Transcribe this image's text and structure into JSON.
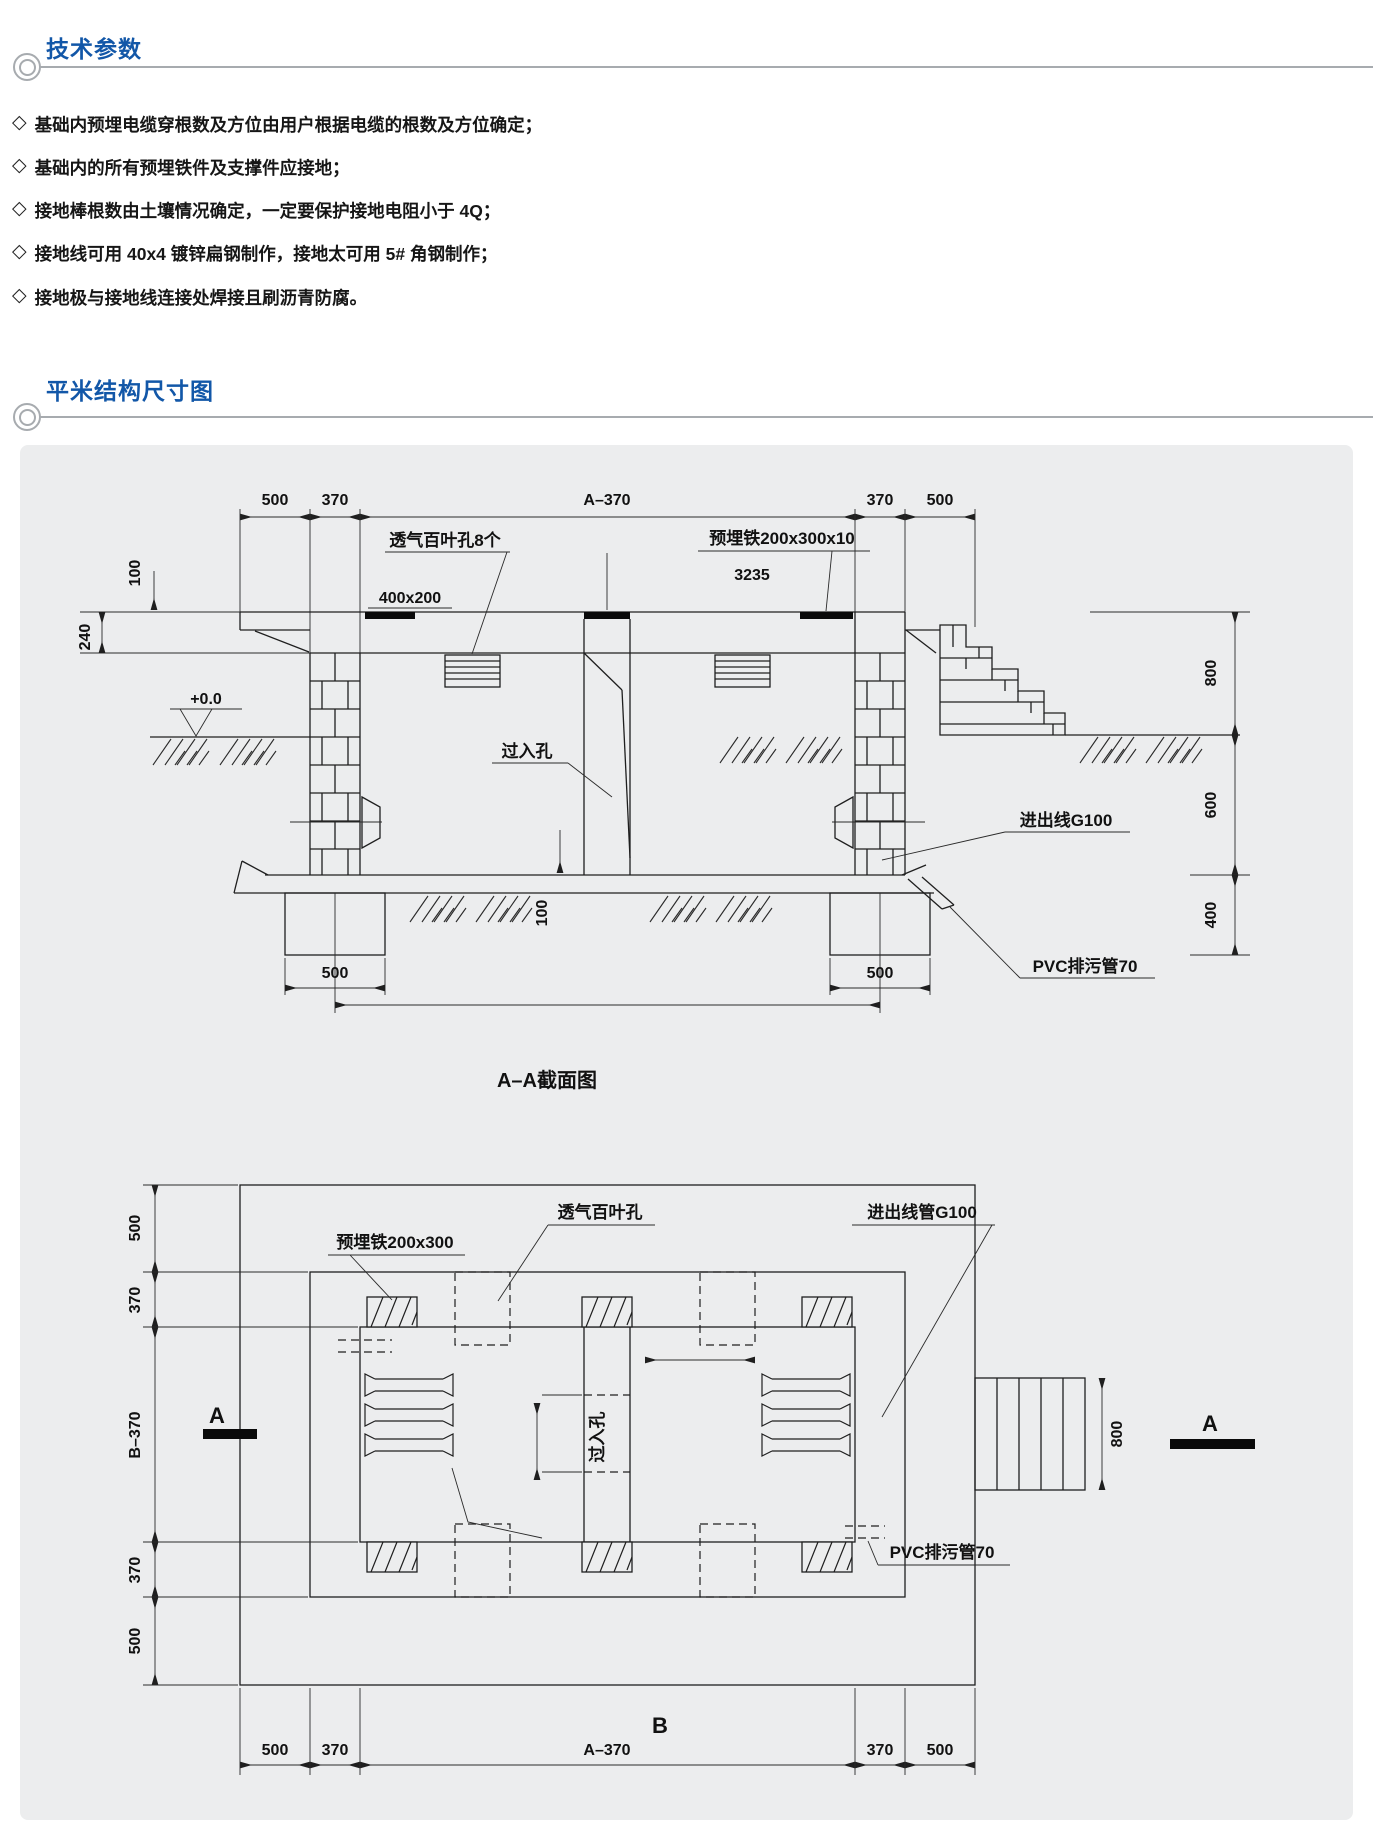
{
  "page": {
    "title1": "技术参数",
    "title2": "平米结构尺寸图",
    "bullet_marker": "◇",
    "bullets": [
      "基础内预埋电缆穿根数及方位由用户根据电缆的根数及方位确定；",
      "基础内的所有预埋铁件及支撑件应接地；",
      "接地棒根数由土壤情况确定，一定要保护接地电阻小于 4Q；",
      "接地线可用 40x4 镀锌扁钢制作，接地太可用 5# 角钢制作；",
      "接地极与接地线连接处焊接且刷沥青防腐。"
    ],
    "accent_color": "#1257a8",
    "rule_color": "#a7abaf",
    "panel_color": "#ecedee"
  },
  "diagram": {
    "section": {
      "caption": "A–A截面图",
      "top_dims": [
        "500",
        "370",
        "A–370",
        "370",
        "500"
      ],
      "louver_label": "透气百叶孔8个",
      "embed_label": "预埋铁200x300x10",
      "embed_code": "3235",
      "vent_size": "400x200",
      "dim100_top": "100",
      "dim240": "240",
      "level": "+0.0",
      "manhole": "过入孔",
      "inout": "进出线G100",
      "dim800": "800",
      "dim600": "600",
      "dim400": "400",
      "pvc": "PVC排污管70",
      "footing_dim_left": "500",
      "footing_dim_right": "500",
      "floor_dim": "100"
    },
    "plan": {
      "embed_label": "预埋铁200x300",
      "louver_label": "透气百叶孔",
      "inout": "进出线管G100",
      "manhole": "过入孔",
      "pvc": "PVC排污管70",
      "dim800": "800",
      "marker_a_left": "A",
      "marker_a_right": "A",
      "marker_b": "B",
      "left_dims": [
        "500",
        "370",
        "B–370",
        "370",
        "500"
      ],
      "bottom_dims": [
        "500",
        "370",
        "A–370",
        "370",
        "500"
      ]
    }
  }
}
